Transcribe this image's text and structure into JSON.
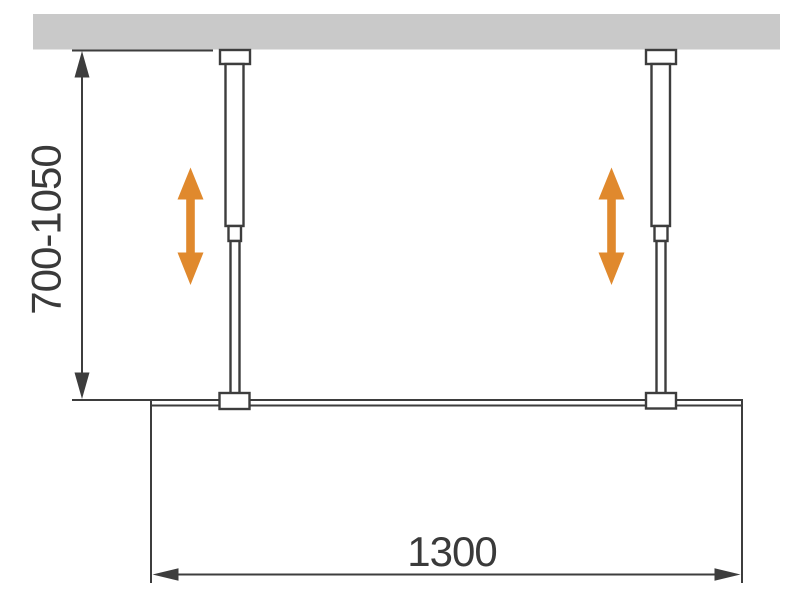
{
  "diagram": {
    "type": "installation-dimension-diagram",
    "dimensions": {
      "rod_height_range": "700-1050",
      "panel_width": "1300"
    },
    "icons": {
      "height_adjust_arrow": "double-vertical-arrow",
      "dimension_arrowhead": "slim-triangle"
    },
    "colors": {
      "background": "#ffffff",
      "ceiling": "#c9c9c9",
      "line": "#3d3d3d",
      "text": "#3a3a3a",
      "arrow": "#e0892d",
      "fixture": "#ffffff"
    }
  }
}
